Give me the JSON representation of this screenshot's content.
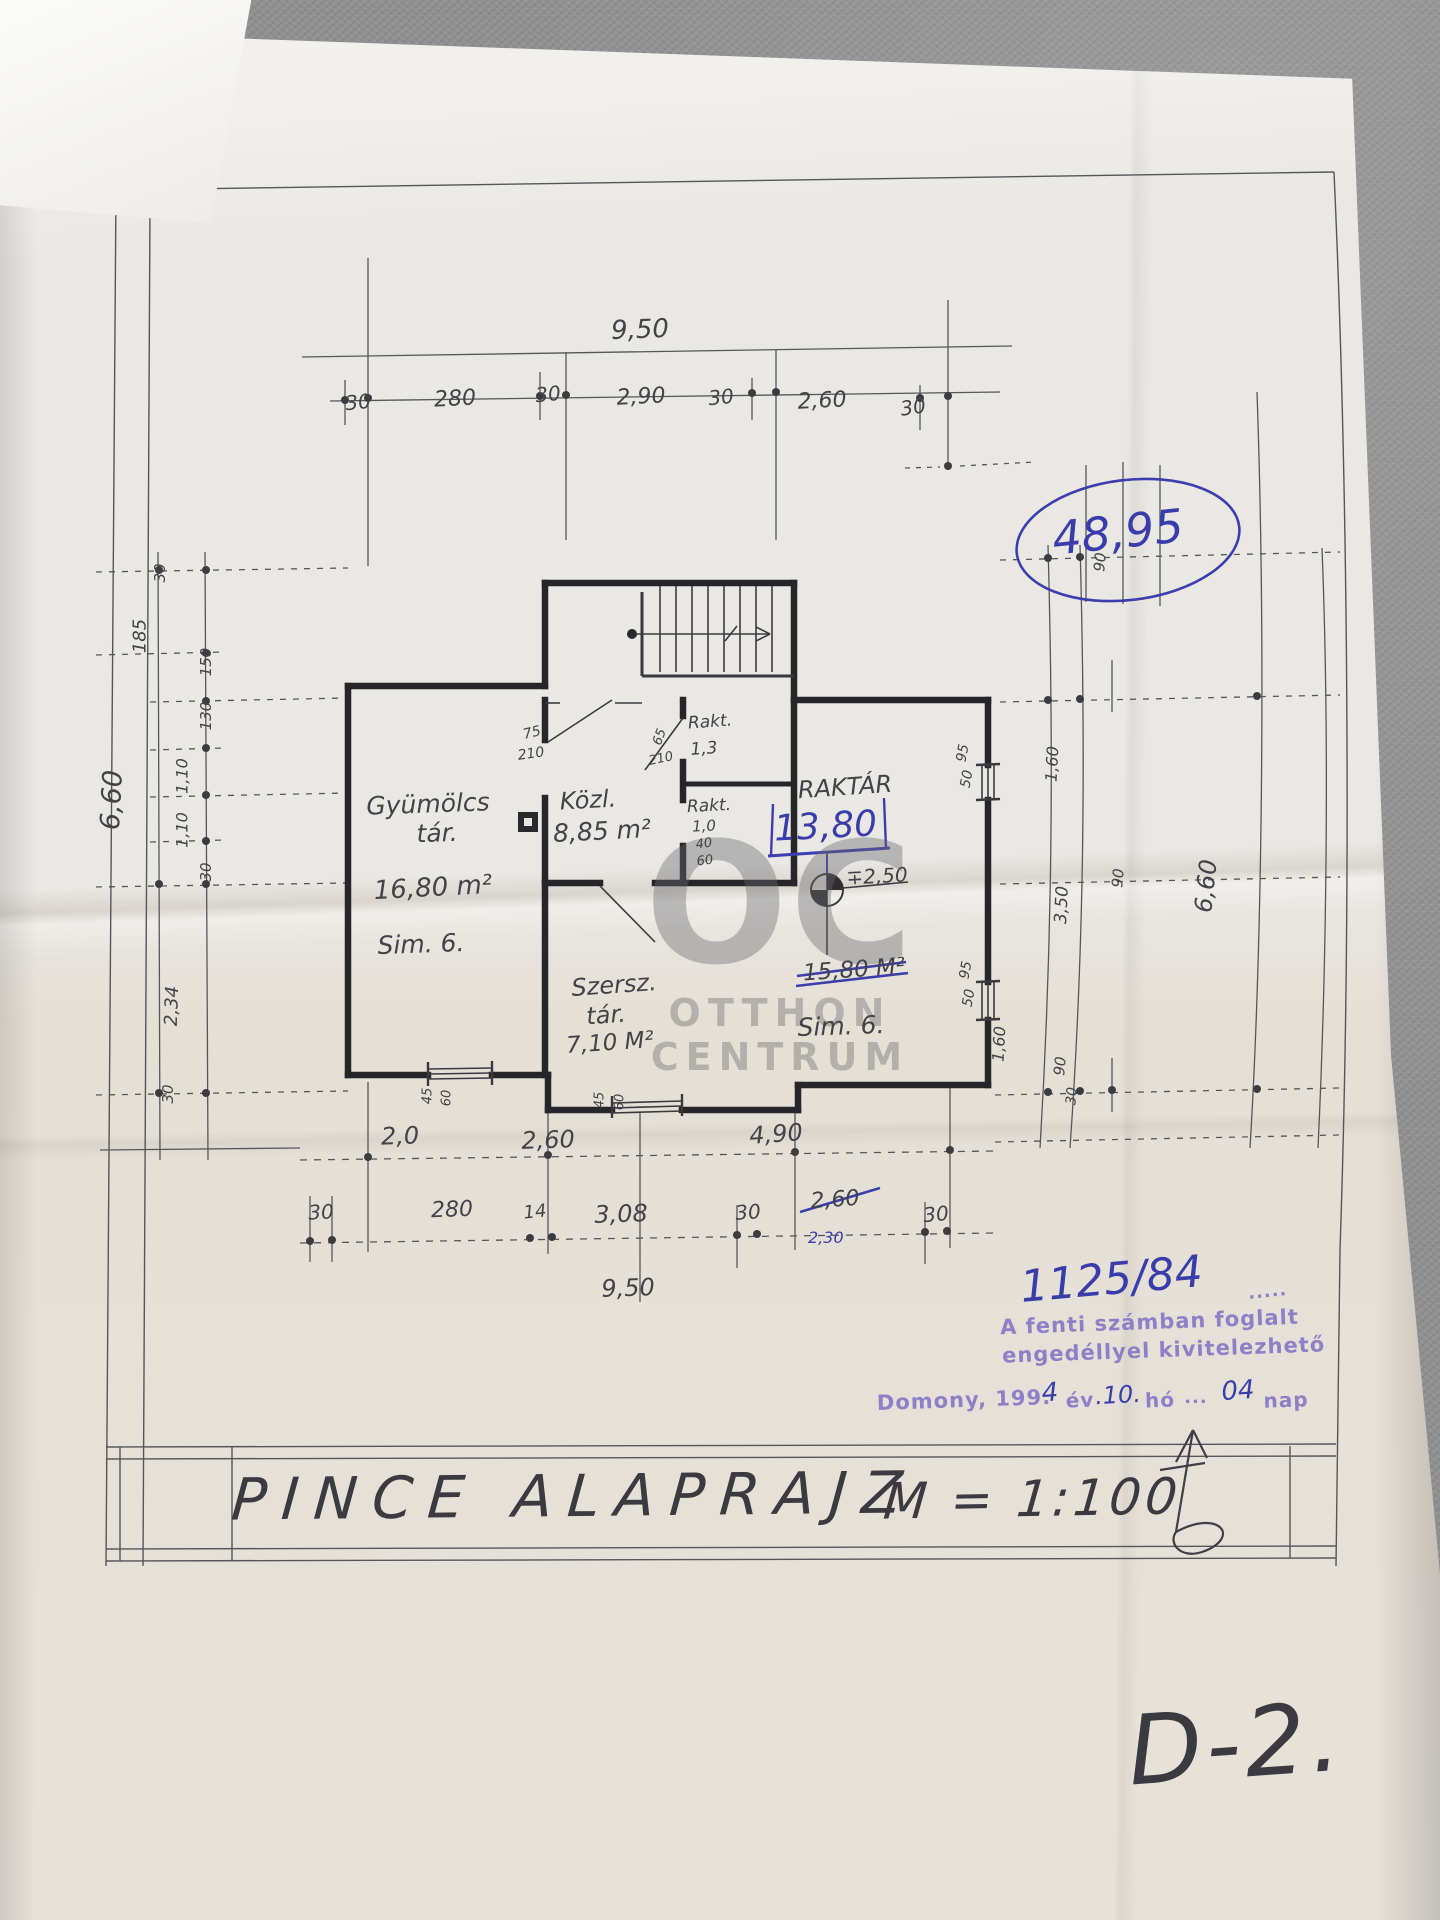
{
  "document": {
    "type": "hand-drawn basement floor plan (photo of paper blueprint)",
    "title": "PINCE ALAPRAJZ",
    "scale": "M = 1:100",
    "sheet_code": "D-2."
  },
  "watermark": {
    "line1": "OC",
    "line2": "OTTHON",
    "line3": "CENTRUM"
  },
  "approval": {
    "total_area_circled": "48,95",
    "permit_number": "1125/84",
    "stamp_line1": "A fenti számban foglalt",
    "stamp_line2": "engedéllyel kivitelezhető",
    "stamp_dots": "·····",
    "raktar_new_area": "13,80",
    "dim_correction_blue": "2,30"
  },
  "rooms": [
    {
      "name": "Gyümölcs tár.",
      "area": "16,80 m²",
      "floor": "Sim. 6."
    },
    {
      "name": "Közl.",
      "area": "8,85 m²"
    },
    {
      "name": "Rakt.",
      "area": "1,3"
    },
    {
      "name": "Rakt.",
      "area": "1,0"
    },
    {
      "name": "Raktár",
      "area_old_crossed": "15,80 M²",
      "area_new": "13,80",
      "floor": "Sim. 6.",
      "level": "∓2,50"
    },
    {
      "name": "Szersz. tár.",
      "area": "7,10 M²"
    }
  ],
  "dimensions": {
    "top_overall": "9,50",
    "top_segments": [
      "30",
      "280",
      "30",
      "2,90",
      "30",
      "2,60",
      "30"
    ],
    "bottom_row1": [
      "2,0",
      "2,60",
      "4,90"
    ],
    "bottom_row2": [
      "30",
      "280",
      "14",
      "3,08",
      "30",
      "2,60",
      "30"
    ],
    "bottom_overall": "9,50",
    "left_chain": [
      "185",
      "30",
      "150",
      "130",
      "1,10",
      "1,10",
      "30",
      "2,34",
      "30"
    ],
    "left_overall": "6,60",
    "right_chain": [
      "90",
      "1,60",
      "95",
      "50",
      "3,50",
      "90",
      "95",
      "50",
      "1,60",
      "90",
      "30"
    ],
    "right_overall": "6,60",
    "door_dims": [
      "75",
      "210",
      "65",
      "210",
      "40",
      "60"
    ],
    "window_dims": [
      "45",
      "60",
      "45",
      "60"
    ]
  },
  "labels": [
    {
      "t": "9,50",
      "x": 640,
      "y": 330,
      "r": -2,
      "s": 26,
      "c": "p",
      "n": "dim-top-overall"
    },
    {
      "t": "30",
      "x": 358,
      "y": 402,
      "r": -6,
      "s": 20,
      "c": "p",
      "n": "dim-top"
    },
    {
      "t": "280",
      "x": 455,
      "y": 399,
      "r": -3,
      "s": 22,
      "c": "p",
      "n": "dim-top"
    },
    {
      "t": "30",
      "x": 548,
      "y": 394,
      "r": -6,
      "s": 20,
      "c": "p",
      "n": "dim-top"
    },
    {
      "t": "2,90",
      "x": 641,
      "y": 397,
      "r": -3,
      "s": 22,
      "c": "p",
      "n": "dim-top"
    },
    {
      "t": "30",
      "x": 721,
      "y": 397,
      "r": -6,
      "s": 20,
      "c": "p",
      "n": "dim-top"
    },
    {
      "t": "2,60",
      "x": 822,
      "y": 401,
      "r": -3,
      "s": 22,
      "c": "p",
      "n": "dim-top"
    },
    {
      "t": "30",
      "x": 913,
      "y": 407,
      "r": -8,
      "s": 20,
      "c": "p",
      "n": "dim-top"
    },
    {
      "t": "185",
      "x": 140,
      "y": 636,
      "r": -90,
      "s": 18,
      "c": "p",
      "n": "dim-left"
    },
    {
      "t": "30",
      "x": 160,
      "y": 573,
      "r": -90,
      "s": 15,
      "c": "p",
      "n": "dim-left"
    },
    {
      "t": "6,60",
      "x": 112,
      "y": 800,
      "r": -87,
      "s": 27,
      "c": "p",
      "n": "dim-left-overall"
    },
    {
      "t": "150",
      "x": 206,
      "y": 662,
      "r": -90,
      "s": 15,
      "c": "p",
      "n": "dim-left"
    },
    {
      "t": "130",
      "x": 206,
      "y": 716,
      "r": -90,
      "s": 15,
      "c": "p",
      "n": "dim-left"
    },
    {
      "t": "1,10",
      "x": 182,
      "y": 776,
      "r": -90,
      "s": 16,
      "c": "p",
      "n": "dim-left"
    },
    {
      "t": "1,10",
      "x": 182,
      "y": 830,
      "r": -90,
      "s": 16,
      "c": "p",
      "n": "dim-left"
    },
    {
      "t": "30",
      "x": 206,
      "y": 872,
      "r": -90,
      "s": 15,
      "c": "p",
      "n": "dim-left"
    },
    {
      "t": "2,34",
      "x": 172,
      "y": 1006,
      "r": -88,
      "s": 18,
      "c": "p",
      "n": "dim-left"
    },
    {
      "t": "30",
      "x": 168,
      "y": 1094,
      "r": -90,
      "s": 15,
      "c": "p",
      "n": "dim-left"
    },
    {
      "t": "90",
      "x": 1100,
      "y": 562,
      "r": -85,
      "s": 15,
      "c": "p",
      "n": "dim-right"
    },
    {
      "t": "1,60",
      "x": 1052,
      "y": 764,
      "r": -87,
      "s": 16,
      "c": "p",
      "n": "dim-right"
    },
    {
      "t": "95",
      "x": 963,
      "y": 753,
      "r": -80,
      "s": 14,
      "c": "p",
      "n": "dim-window"
    },
    {
      "t": "50",
      "x": 967,
      "y": 779,
      "r": -80,
      "s": 14,
      "c": "p",
      "n": "dim-window"
    },
    {
      "t": "3,50",
      "x": 1062,
      "y": 905,
      "r": -87,
      "s": 17,
      "c": "p",
      "n": "dim-right"
    },
    {
      "t": "90",
      "x": 1118,
      "y": 878,
      "r": -85,
      "s": 15,
      "c": "p",
      "n": "dim-right"
    },
    {
      "t": "6,60",
      "x": 1206,
      "y": 886,
      "r": -84,
      "s": 24,
      "c": "p",
      "n": "dim-right-overall"
    },
    {
      "t": "95",
      "x": 966,
      "y": 970,
      "r": -80,
      "s": 14,
      "c": "p",
      "n": "dim-window"
    },
    {
      "t": "50",
      "x": 969,
      "y": 998,
      "r": -80,
      "s": 14,
      "c": "p",
      "n": "dim-window"
    },
    {
      "t": "1,60",
      "x": 999,
      "y": 1044,
      "r": -87,
      "s": 16,
      "c": "p",
      "n": "dim-right"
    },
    {
      "t": "90",
      "x": 1060,
      "y": 1066,
      "r": -85,
      "s": 15,
      "c": "p",
      "n": "dim-right"
    },
    {
      "t": "30",
      "x": 1072,
      "y": 1096,
      "r": -85,
      "s": 14,
      "c": "p",
      "n": "dim-right"
    },
    {
      "t": "Gyümölcs",
      "x": 428,
      "y": 804,
      "r": -2,
      "s": 25,
      "c": "p",
      "n": "room-label-gyumolcs-tar"
    },
    {
      "t": "tár.",
      "x": 437,
      "y": 833,
      "r": -2,
      "s": 25,
      "c": "p",
      "n": "room-label-gyumolcs-tar"
    },
    {
      "t": "16,80 m²",
      "x": 433,
      "y": 888,
      "r": -3,
      "s": 26,
      "c": "p",
      "n": "room-area-gyumolcs-tar"
    },
    {
      "t": "Sim. 6.",
      "x": 421,
      "y": 944,
      "r": -2,
      "s": 25,
      "c": "p",
      "n": "room-floor-gyumolcs-tar"
    },
    {
      "t": "Közl.",
      "x": 588,
      "y": 800,
      "r": -3,
      "s": 24,
      "c": "p",
      "n": "room-label-kozl"
    },
    {
      "t": "8,85 m²",
      "x": 602,
      "y": 831,
      "r": -3,
      "s": 25,
      "c": "p",
      "n": "room-area-kozl"
    },
    {
      "t": "Rakt.",
      "x": 710,
      "y": 722,
      "r": -4,
      "s": 17,
      "c": "p",
      "n": "room-label-rakt-1"
    },
    {
      "t": "1,3",
      "x": 704,
      "y": 749,
      "r": -4,
      "s": 17,
      "c": "p",
      "n": "room-area-rakt-1"
    },
    {
      "t": "Rakt.",
      "x": 709,
      "y": 806,
      "r": -3,
      "s": 17,
      "c": "p",
      "n": "room-label-rakt-2"
    },
    {
      "t": "1,0",
      "x": 704,
      "y": 826,
      "r": -3,
      "s": 15,
      "c": "p",
      "n": "room-area-rakt-2"
    },
    {
      "t": "40",
      "x": 704,
      "y": 844,
      "r": -8,
      "s": 13,
      "c": "p",
      "n": "dim-door"
    },
    {
      "t": "60",
      "x": 705,
      "y": 861,
      "r": -8,
      "s": 13,
      "c": "p",
      "n": "dim-door"
    },
    {
      "t": "RAKTÁR",
      "x": 845,
      "y": 787,
      "r": -4,
      "s": 24,
      "c": "p",
      "n": "room-label-raktar"
    },
    {
      "t": "∓2,50",
      "x": 877,
      "y": 876,
      "r": -3,
      "s": 20,
      "c": "p",
      "n": "level-mark-value"
    },
    {
      "t": "15,80 M²",
      "x": 854,
      "y": 970,
      "r": -4,
      "s": 23,
      "c": "p",
      "n": "room-area-raktar-old"
    },
    {
      "t": "Sim. 6.",
      "x": 841,
      "y": 1026,
      "r": -2,
      "s": 25,
      "c": "p",
      "n": "room-floor-raktar"
    },
    {
      "t": "Szersz.",
      "x": 614,
      "y": 985,
      "r": -4,
      "s": 24,
      "c": "p",
      "n": "room-label-szersz-tar"
    },
    {
      "t": "tár.",
      "x": 606,
      "y": 1015,
      "r": -4,
      "s": 24,
      "c": "p",
      "n": "room-label-szersz-tar"
    },
    {
      "t": "7,10 M²",
      "x": 610,
      "y": 1043,
      "r": -4,
      "s": 23,
      "c": "p",
      "n": "room-area-szersz-tar"
    },
    {
      "t": "75",
      "x": 532,
      "y": 733,
      "r": -14,
      "s": 14,
      "c": "p",
      "n": "dim-door"
    },
    {
      "t": "210",
      "x": 531,
      "y": 754,
      "r": -8,
      "s": 14,
      "c": "p",
      "n": "dim-door"
    },
    {
      "t": "65",
      "x": 660,
      "y": 737,
      "r": -70,
      "s": 13,
      "c": "p",
      "n": "dim-door"
    },
    {
      "t": "210",
      "x": 661,
      "y": 759,
      "r": -12,
      "s": 13,
      "c": "p",
      "n": "dim-door"
    },
    {
      "t": "45",
      "x": 428,
      "y": 1096,
      "r": -90,
      "s": 13,
      "c": "p",
      "n": "dim-window"
    },
    {
      "t": "60",
      "x": 447,
      "y": 1098,
      "r": -90,
      "s": 13,
      "c": "p",
      "n": "dim-window"
    },
    {
      "t": "45",
      "x": 600,
      "y": 1100,
      "r": -90,
      "s": 13,
      "c": "p",
      "n": "dim-window"
    },
    {
      "t": "60",
      "x": 620,
      "y": 1102,
      "r": -90,
      "s": 13,
      "c": "p",
      "n": "dim-window"
    },
    {
      "t": "2,0",
      "x": 400,
      "y": 1136,
      "r": -2,
      "s": 24,
      "c": "p",
      "n": "dim-bottom"
    },
    {
      "t": "2,60",
      "x": 548,
      "y": 1140,
      "r": -2,
      "s": 24,
      "c": "p",
      "n": "dim-bottom"
    },
    {
      "t": "4,90",
      "x": 776,
      "y": 1134,
      "r": -4,
      "s": 24,
      "c": "p",
      "n": "dim-bottom"
    },
    {
      "t": "30",
      "x": 321,
      "y": 1212,
      "r": -3,
      "s": 20,
      "c": "p",
      "n": "dim-bottom"
    },
    {
      "t": "280",
      "x": 452,
      "y": 1210,
      "r": -2,
      "s": 22,
      "c": "p",
      "n": "dim-bottom"
    },
    {
      "t": "14",
      "x": 535,
      "y": 1212,
      "r": -6,
      "s": 18,
      "c": "p",
      "n": "dim-bottom"
    },
    {
      "t": "3,08",
      "x": 621,
      "y": 1214,
      "r": -2,
      "s": 24,
      "c": "p",
      "n": "dim-bottom"
    },
    {
      "t": "30",
      "x": 748,
      "y": 1212,
      "r": -4,
      "s": 20,
      "c": "p",
      "n": "dim-bottom"
    },
    {
      "t": "2,60",
      "x": 835,
      "y": 1200,
      "r": -4,
      "s": 22,
      "c": "p",
      "n": "dim-bottom-crossed"
    },
    {
      "t": "30",
      "x": 936,
      "y": 1214,
      "r": -5,
      "s": 20,
      "c": "p",
      "n": "dim-bottom"
    },
    {
      "t": "9,50",
      "x": 628,
      "y": 1288,
      "r": -2,
      "s": 24,
      "c": "p",
      "n": "dim-bottom-overall"
    },
    {
      "t": "Domony, 199.",
      "x": 964,
      "y": 1400,
      "r": -2,
      "s": 21,
      "c": "v",
      "n": "stamp-place"
    },
    {
      "t": "4",
      "x": 1050,
      "y": 1393,
      "r": -4,
      "s": 26,
      "c": "b",
      "n": "stamp-year-handwritten"
    },
    {
      "t": "év",
      "x": 1080,
      "y": 1400,
      "r": -2,
      "s": 20,
      "c": "v",
      "n": "stamp-ev"
    },
    {
      "t": ".10.",
      "x": 1118,
      "y": 1395,
      "r": -3,
      "s": 24,
      "c": "b",
      "n": "stamp-month-handwritten"
    },
    {
      "t": "hó",
      "x": 1160,
      "y": 1400,
      "r": -2,
      "s": 20,
      "c": "v",
      "n": "stamp-ho"
    },
    {
      "t": "···",
      "x": 1196,
      "y": 1402,
      "r": 0,
      "s": 18,
      "c": "v",
      "n": "stamp-dots"
    },
    {
      "t": "04",
      "x": 1238,
      "y": 1391,
      "r": -4,
      "s": 26,
      "c": "b",
      "n": "stamp-day-handwritten"
    },
    {
      "t": "nap",
      "x": 1286,
      "y": 1400,
      "r": -2,
      "s": 20,
      "c": "v",
      "n": "stamp-nap"
    },
    {
      "t": "·····",
      "x": 1268,
      "y": 1296,
      "r": -6,
      "s": 18,
      "c": "v",
      "n": "stamp-dotline"
    }
  ]
}
